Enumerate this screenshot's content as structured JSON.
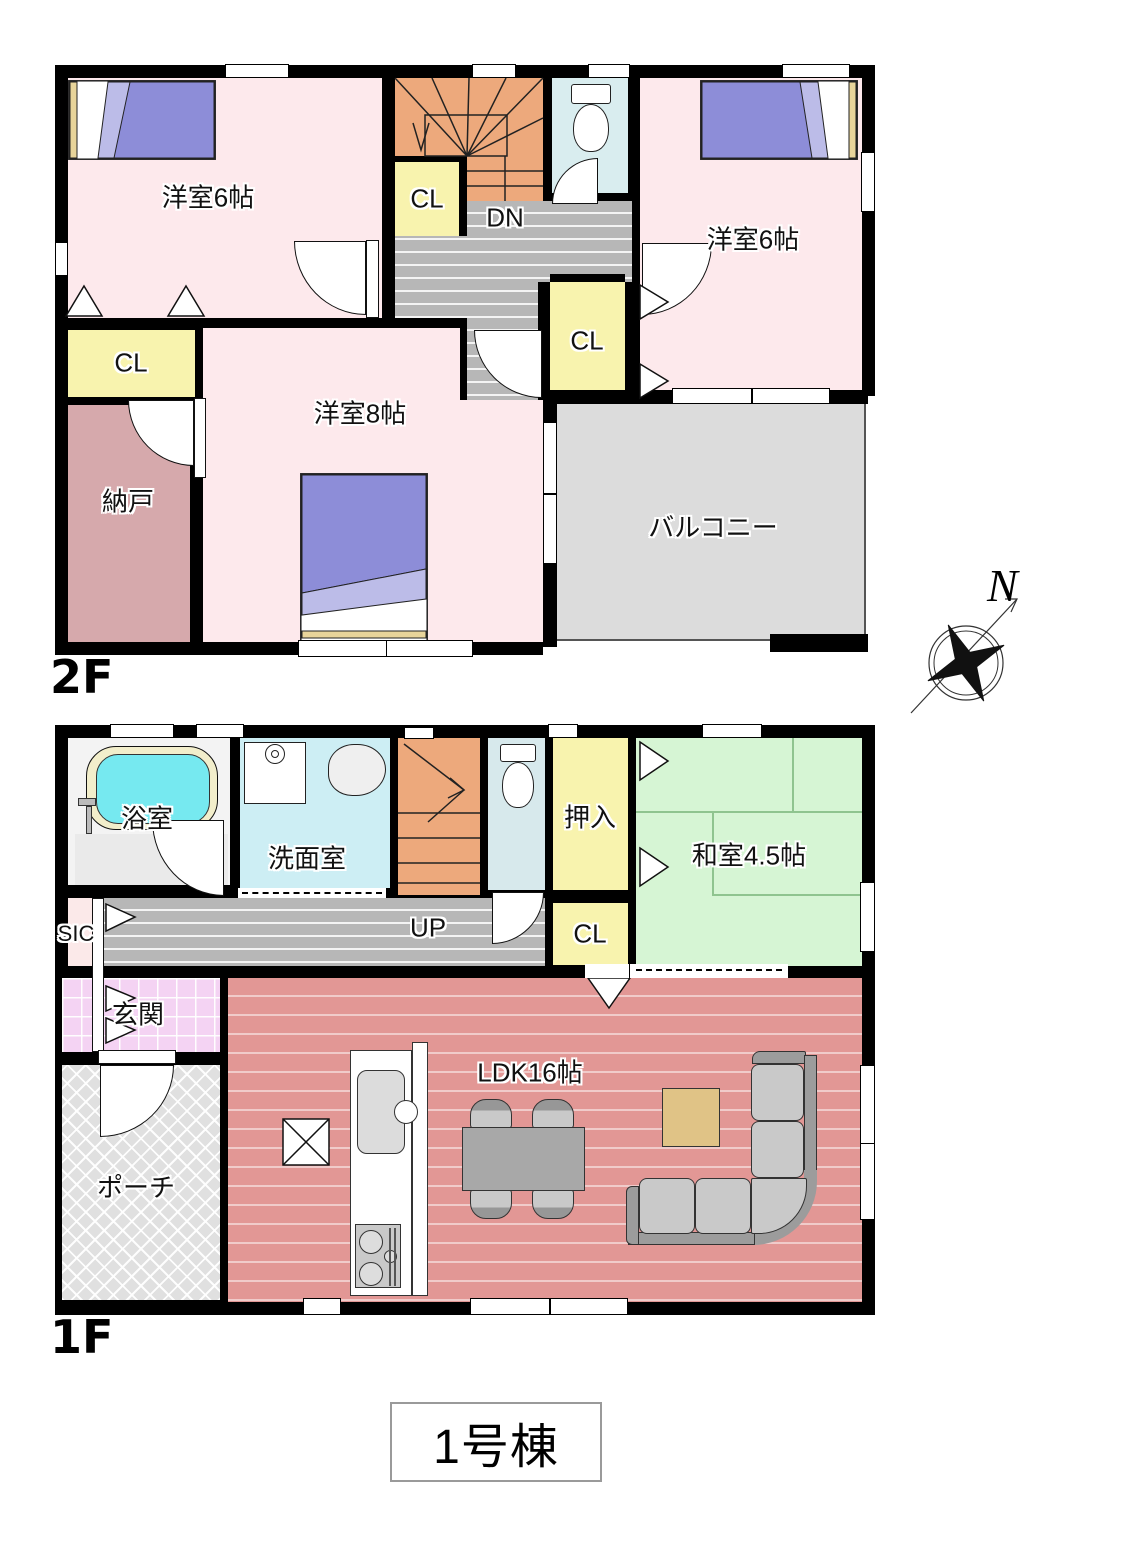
{
  "title": {
    "text": "1号棟"
  },
  "compass": {
    "north": "N"
  },
  "floor2": {
    "floor_label": "2F",
    "bedroom_nw": "洋室6帖",
    "bedroom_ne": "洋室6帖",
    "bedroom_s": "洋室8帖",
    "closet_west": "CL",
    "closet_mid": "CL",
    "closet_east": "CL",
    "stairs_dn": "DN",
    "storage": "納戸",
    "balcony": "バルコニー"
  },
  "floor1": {
    "floor_label": "1F",
    "bath": "浴室",
    "washroom": "洗面室",
    "stairs_up": "UP",
    "oshiire": "押入",
    "washitsu": "和室4.5帖",
    "closet": "CL",
    "sic": "SIC",
    "genkan": "玄関",
    "porch": "ポーチ",
    "ldk": "LDK16帖"
  },
  "colors": {
    "bedroom_pink": "#fde9ec",
    "closet_yellow": "#f8f3ae",
    "stairs_orange": "#eda97c",
    "corridor_gray": "#b7b7b7",
    "toilet_cyan": "#d9edef",
    "storage_rose": "#d6a9ac",
    "balcony_gray": "#dcdcdc",
    "washitsu_green": "#d6f5d4",
    "ldk_salmon": "#e29795",
    "genkan_pink": "#f4d3f3",
    "bathtub_cyan": "#76e9f0",
    "bed_purple": "#8d8dd8",
    "sofa_gray": "#c9c9c9",
    "table_tan": "#e0c386"
  }
}
